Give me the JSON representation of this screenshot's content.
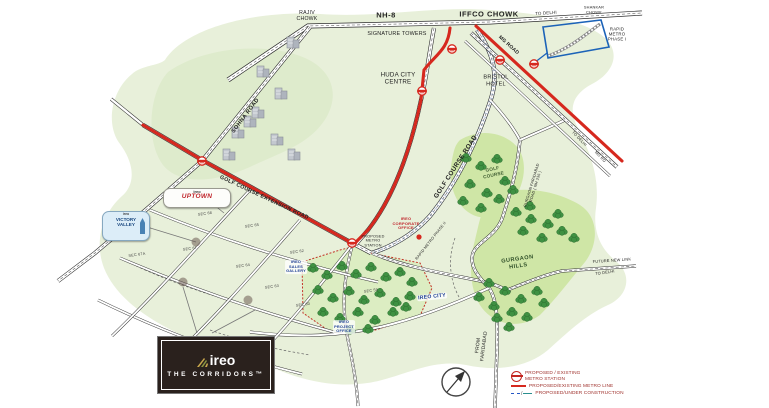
{
  "map": {
    "labels": [
      {
        "t": "RAJIV\nCHOWK",
        "x": 307,
        "y": 16,
        "s": 5.2
      },
      {
        "t": "NH-8",
        "x": 386,
        "y": 16,
        "s": 7.5,
        "w": 700,
        "ls": 0.5
      },
      {
        "t": "SIGNATURE TOWERS",
        "x": 397,
        "y": 34,
        "s": 5.4
      },
      {
        "t": "IFFCO CHOWK",
        "x": 489,
        "y": 15,
        "s": 7.5,
        "w": 700,
        "ls": 0.5
      },
      {
        "t": "TO DELHI",
        "x": 546,
        "y": 13,
        "s": 4.4,
        "r": -4
      },
      {
        "t": "SHANKAR\nCHOWK",
        "x": 594,
        "y": 10,
        "s": 3.9
      },
      {
        "t": "RAPID\nMETRO\nPHASE I",
        "x": 617,
        "y": 34,
        "s": 4.3
      },
      {
        "t": "MG ROAD",
        "x": 508,
        "y": 46,
        "s": 5,
        "r": 42,
        "w": 700
      },
      {
        "t": "HUDA CITY\nCENTRE",
        "x": 398,
        "y": 79,
        "s": 6.2
      },
      {
        "t": "BRISTOL\nHOTEL",
        "x": 496,
        "y": 81,
        "s": 5.6
      },
      {
        "t": "SOHNA ROAD",
        "x": 246,
        "y": 116,
        "s": 5.6,
        "r": -53,
        "w": 700,
        "ls": 0.4
      },
      {
        "t": "GOLF COURSE EXTENSION ROAD",
        "x": 264,
        "y": 198,
        "s": 5.4,
        "r": 25,
        "w": 700,
        "ls": 0.3
      },
      {
        "t": "GOLF COURSE ROAD",
        "x": 456,
        "y": 167,
        "s": 6.4,
        "r": -57,
        "w": 700,
        "ls": 0.4
      },
      {
        "t": "GOLF\nCOURSE",
        "x": 493,
        "y": 172,
        "s": 4.7,
        "r": -12,
        "c": "#3f5d32",
        "w": 700
      },
      {
        "t": "RAPID METRO PHASE II",
        "x": 431,
        "y": 241,
        "s": 3.8,
        "r": -52
      },
      {
        "t": "IREO\nCORPORATE\nOFFICE",
        "x": 406,
        "y": 224,
        "s": 4,
        "c": "#c0272d",
        "w": 700
      },
      {
        "t": "PROPOSED\nMETRO\nSTATION",
        "x": 373,
        "y": 241,
        "s": 3.8
      },
      {
        "t": "GURGAON FARIDABAD\nROAD ( NH 236 )",
        "x": 534,
        "y": 186,
        "s": 3.8,
        "r": -73
      },
      {
        "t": "GURGAON\nHILLS",
        "x": 518,
        "y": 263,
        "s": 5.6,
        "r": -8,
        "c": "#2f4f28",
        "w": 700,
        "ls": 0.5
      },
      {
        "t": "FUTURE NEW LINK",
        "x": 612,
        "y": 261,
        "s": 3.9,
        "r": -4
      },
      {
        "t": "TO DELHI",
        "x": 605,
        "y": 273,
        "s": 3.9,
        "r": -8
      },
      {
        "t": "TO DELHI",
        "x": 579,
        "y": 139,
        "s": 3.9,
        "r": 46
      },
      {
        "t": "MG RD",
        "x": 600,
        "y": 157,
        "s": 3.9,
        "r": 46
      },
      {
        "t": "FROM\nFARIDABAD",
        "x": 482,
        "y": 346,
        "s": 5,
        "r": -83
      },
      {
        "t": "IREO CITY",
        "x": 432,
        "y": 297,
        "s": 5.2,
        "c": "#1e3f94",
        "w": 700,
        "r": -6,
        "bg": 1
      },
      {
        "t": "IREO\nSALES\nGALLERY",
        "x": 296,
        "y": 267,
        "s": 3.9,
        "c": "#1e3f94",
        "w": 700,
        "bg": 1
      },
      {
        "t": "IREO\nPROJECT\nOFFICE",
        "x": 344,
        "y": 327,
        "s": 3.9,
        "c": "#1e3f94",
        "w": 700,
        "bg": 1
      },
      {
        "t": "SEC 68",
        "x": 205,
        "y": 214,
        "s": 3.8,
        "c": "#444",
        "r": -8
      },
      {
        "t": "SEC 65",
        "x": 252,
        "y": 226,
        "s": 3.8,
        "c": "#444",
        "r": -8
      },
      {
        "t": "SEC 67",
        "x": 190,
        "y": 249,
        "s": 3.8,
        "c": "#444",
        "r": -8
      },
      {
        "t": "SEC 67A",
        "x": 137,
        "y": 255,
        "s": 3.8,
        "c": "#444",
        "r": -8
      },
      {
        "t": "SEC 64",
        "x": 243,
        "y": 266,
        "s": 3.8,
        "c": "#444",
        "r": -8
      },
      {
        "t": "SEC 62",
        "x": 297,
        "y": 252,
        "s": 3.8,
        "c": "#444",
        "r": -8
      },
      {
        "t": "SEC 63",
        "x": 272,
        "y": 287,
        "s": 3.8,
        "c": "#444",
        "r": -8
      },
      {
        "t": "SEC 60",
        "x": 303,
        "y": 305,
        "s": 3.8,
        "c": "#444",
        "r": -8
      },
      {
        "t": "SEC 59",
        "x": 371,
        "y": 291,
        "s": 3.8,
        "c": "#444",
        "r": -8
      }
    ],
    "stations": [
      [
        452,
        49
      ],
      [
        422,
        91
      ],
      [
        500,
        60
      ],
      [
        534,
        64
      ],
      [
        202,
        161
      ],
      [
        352,
        243
      ]
    ],
    "trees": [
      [
        466,
        158
      ],
      [
        481,
        166
      ],
      [
        497,
        159
      ],
      [
        470,
        184
      ],
      [
        487,
        193
      ],
      [
        505,
        181
      ],
      [
        463,
        201
      ],
      [
        481,
        208
      ],
      [
        499,
        199
      ],
      [
        513,
        190
      ],
      [
        516,
        212
      ],
      [
        531,
        219
      ],
      [
        548,
        224
      ],
      [
        562,
        231
      ],
      [
        523,
        231
      ],
      [
        542,
        238
      ],
      [
        574,
        238
      ],
      [
        558,
        214
      ],
      [
        530,
        206
      ],
      [
        489,
        283
      ],
      [
        505,
        291
      ],
      [
        521,
        299
      ],
      [
        537,
        291
      ],
      [
        494,
        306
      ],
      [
        512,
        312
      ],
      [
        527,
        317
      ],
      [
        479,
        297
      ],
      [
        544,
        303
      ],
      [
        509,
        327
      ],
      [
        497,
        318
      ],
      [
        313,
        268
      ],
      [
        327,
        275
      ],
      [
        342,
        266
      ],
      [
        356,
        274
      ],
      [
        371,
        267
      ],
      [
        386,
        277
      ],
      [
        400,
        272
      ],
      [
        412,
        282
      ],
      [
        318,
        290
      ],
      [
        333,
        298
      ],
      [
        349,
        291
      ],
      [
        364,
        300
      ],
      [
        380,
        293
      ],
      [
        396,
        302
      ],
      [
        410,
        296
      ],
      [
        323,
        312
      ],
      [
        340,
        318
      ],
      [
        358,
        312
      ],
      [
        375,
        320
      ],
      [
        393,
        312
      ],
      [
        406,
        307
      ],
      [
        350,
        330
      ],
      [
        368,
        329
      ]
    ],
    "buildings": [
      [
        293,
        46
      ],
      [
        263,
        75
      ],
      [
        281,
        97
      ],
      [
        258,
        116
      ],
      [
        238,
        136
      ],
      [
        229,
        158
      ],
      [
        277,
        143
      ],
      [
        294,
        158
      ],
      [
        250,
        125
      ]
    ],
    "smudges": [
      [
        196,
        242
      ],
      [
        183,
        282
      ],
      [
        248,
        300
      ]
    ]
  },
  "callouts": {
    "uptown": {
      "brand": "ireo",
      "name": "UPTOWN"
    },
    "victory_valley": {
      "brand": "ireo",
      "name": "VICTORY\nVALLEY"
    }
  },
  "legend": {
    "station_label": "PROPOSED / EXISTING\nMETRO STATION",
    "line1_label": "PROPOSED/EXISTING METRO LINE",
    "line2_label": "PROPOSED/UNDER CONSTRUCTION"
  },
  "logo": {
    "brand": "ireo",
    "tagline": "THE CORRIDORS™"
  },
  "colors": {
    "metro_red": "#d6281e",
    "proposed_blue": "#2457c5",
    "under_construction_teal": "#2a8f8f"
  }
}
